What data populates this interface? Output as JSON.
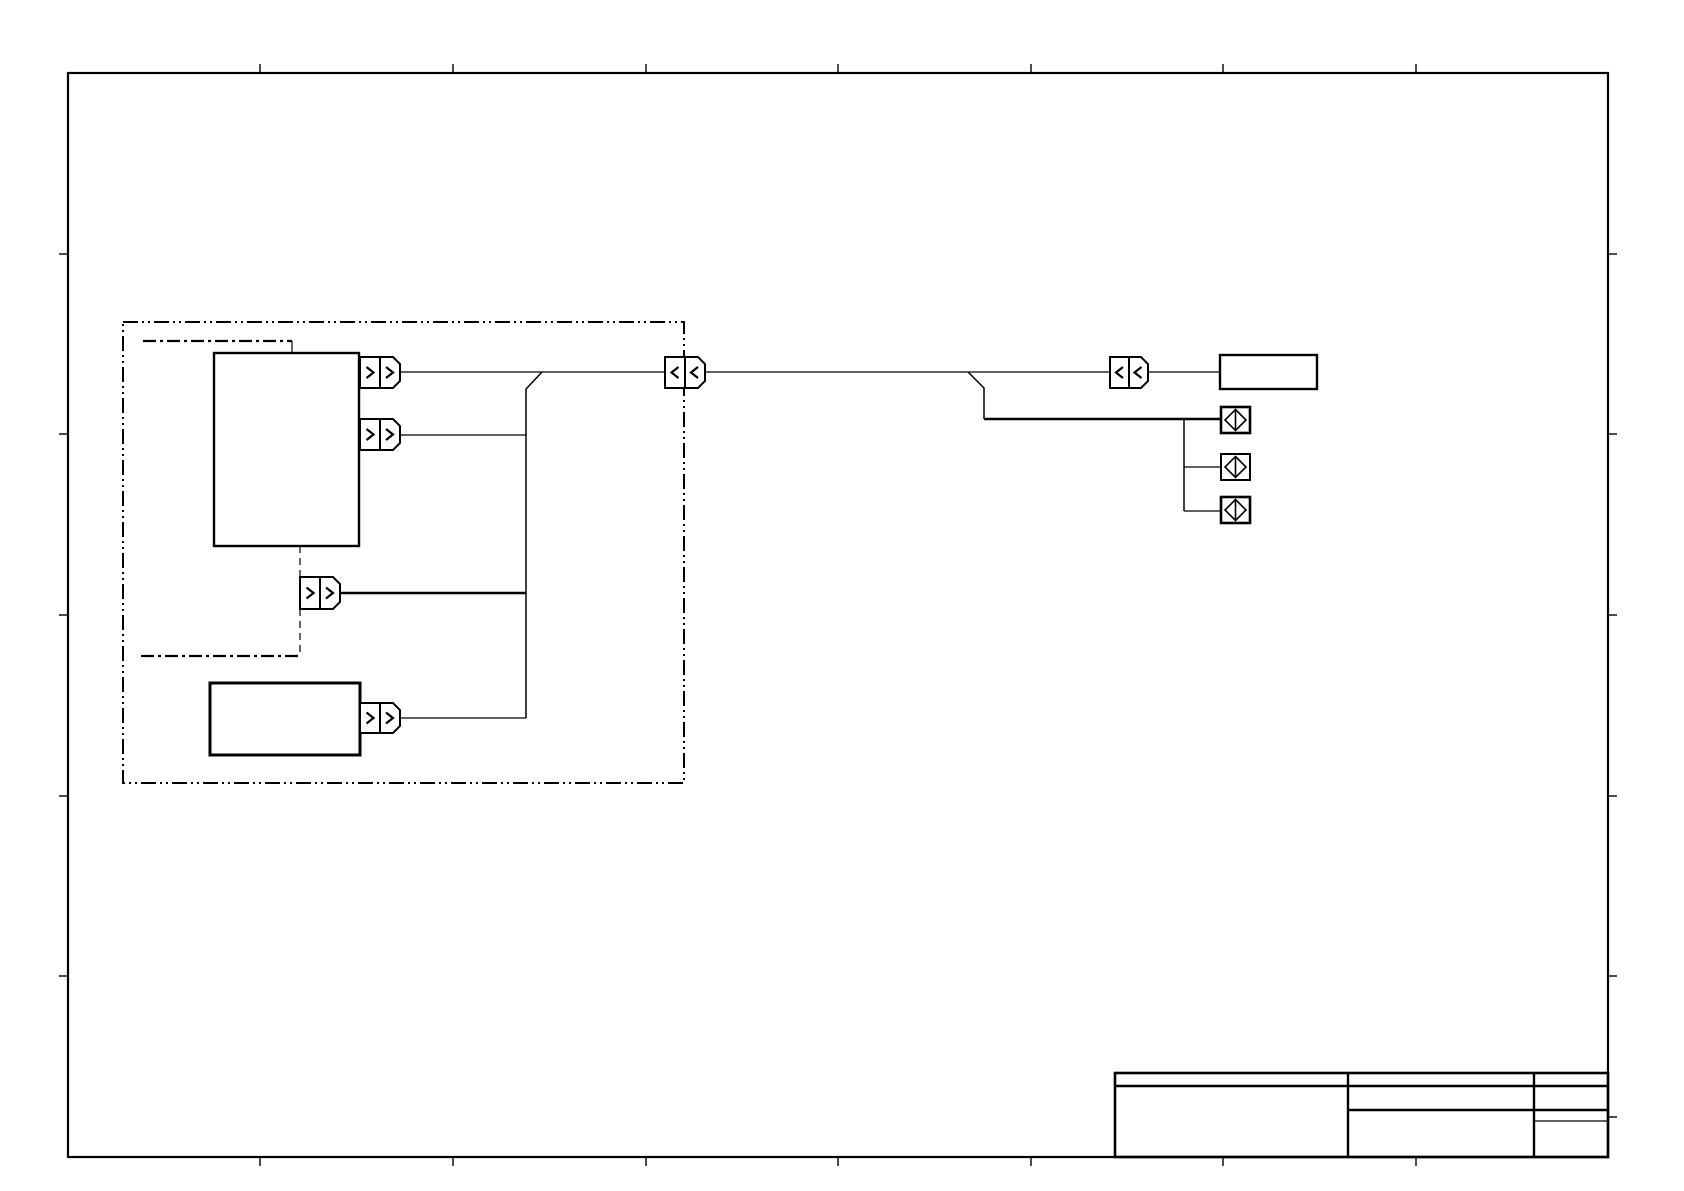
{
  "document": {
    "kind": "wiring-diagram-sheet",
    "background": "#ffffff",
    "ink": "#000000",
    "width": 1684,
    "height": 1191
  },
  "frame": {
    "x": 68,
    "y": 73,
    "w": 1540,
    "h": 1084,
    "stroke_width": 2.2,
    "tick_len": 9,
    "tick_stroke": 1.4,
    "ticks_top_x": [
      260,
      453,
      646,
      838,
      1031,
      1223,
      1416
    ],
    "ticks_bottom_x": [
      260,
      453,
      646,
      838,
      1031,
      1223,
      1416
    ],
    "ticks_left_y": [
      254,
      434,
      615,
      796,
      976
    ],
    "ticks_right_y": [
      254,
      434,
      615,
      796,
      976,
      1117
    ]
  },
  "shapes": [
    {
      "name": "component-group-boundary",
      "kind": "rect",
      "x": 123,
      "y": 322,
      "w": 561,
      "h": 461,
      "sw": 2,
      "dash": "15 4 2 4 2 4",
      "fill": "none",
      "inter": false
    },
    {
      "name": "sub-boundary-top-line",
      "kind": "line",
      "x1": 143,
      "y1": 341,
      "x2": 292,
      "y2": 341,
      "sw": 2.2,
      "dash": "13 4 3 4",
      "inter": false
    },
    {
      "name": "sub-boundary-top-drop",
      "kind": "line",
      "x1": 292,
      "y1": 341,
      "x2": 292,
      "y2": 353,
      "sw": 1.2,
      "inter": false
    },
    {
      "name": "sub-boundary-bottom-line",
      "kind": "line",
      "x1": 141,
      "y1": 656,
      "x2": 300,
      "y2": 656,
      "sw": 2.2,
      "dash": "13 4 3 4",
      "inter": false
    },
    {
      "name": "dashed-link-upper",
      "kind": "line",
      "x1": 300,
      "y1": 546,
      "x2": 300,
      "y2": 577,
      "sw": 1.2,
      "dash": "7 5",
      "inter": false
    },
    {
      "name": "dashed-link-lower",
      "kind": "line",
      "x1": 300,
      "y1": 609,
      "x2": 300,
      "y2": 656,
      "sw": 1.2,
      "dash": "7 5",
      "inter": false
    },
    {
      "name": "wire-main-left",
      "kind": "line",
      "x1": 400,
      "y1": 372,
      "x2": 665,
      "y2": 372,
      "sw": 1.3,
      "inter": false
    },
    {
      "name": "wire-main-mid",
      "kind": "line",
      "x1": 705,
      "y1": 372,
      "x2": 1110,
      "y2": 372,
      "sw": 1.3,
      "inter": false
    },
    {
      "name": "wire-main-right",
      "kind": "line",
      "x1": 1148,
      "y1": 372,
      "x2": 1220,
      "y2": 372,
      "sw": 1.3,
      "inter": false
    },
    {
      "name": "harness-vertical",
      "kind": "polyline",
      "pts": "542,372 526,389 526,718",
      "sw": 1.5,
      "inter": false
    },
    {
      "name": "wire-branch-2",
      "kind": "line",
      "x1": 400,
      "y1": 435,
      "x2": 526,
      "y2": 435,
      "sw": 1.3,
      "inter": false
    },
    {
      "name": "wire-branch-3-bold",
      "kind": "line",
      "x1": 340,
      "y1": 593,
      "x2": 526,
      "y2": 593,
      "sw": 2.6,
      "inter": false
    },
    {
      "name": "wire-branch-4",
      "kind": "line",
      "x1": 400,
      "y1": 718,
      "x2": 526,
      "y2": 718,
      "sw": 1.3,
      "inter": false
    },
    {
      "name": "wire-splice-drop",
      "kind": "polyline",
      "pts": "968,372 984,388 984,419",
      "sw": 1.5,
      "inter": false
    },
    {
      "name": "wire-splice-feed-bold",
      "kind": "line",
      "x1": 984,
      "y1": 419,
      "x2": 1221,
      "y2": 419,
      "sw": 2.6,
      "inter": false
    },
    {
      "name": "splice-bus-vertical",
      "kind": "line",
      "x1": 1184,
      "y1": 419,
      "x2": 1184,
      "y2": 511,
      "sw": 1.5,
      "inter": false
    },
    {
      "name": "splice-stub-2",
      "kind": "line",
      "x1": 1184,
      "y1": 467,
      "x2": 1221,
      "y2": 467,
      "sw": 1.3,
      "inter": false
    },
    {
      "name": "splice-stub-3",
      "kind": "line",
      "x1": 1184,
      "y1": 511,
      "x2": 1221,
      "y2": 511,
      "sw": 1.3,
      "inter": false
    },
    {
      "name": "component-box-main",
      "kind": "rect",
      "x": 214,
      "y": 353,
      "w": 145,
      "h": 193,
      "sw": 2.4,
      "fill": "#ffffff",
      "inter": true
    },
    {
      "name": "component-box-secondary",
      "kind": "rect",
      "x": 210,
      "y": 683,
      "w": 150,
      "h": 72,
      "sw": 3,
      "fill": "#ffffff",
      "inter": true
    },
    {
      "name": "component-box-right",
      "kind": "rect",
      "x": 1220,
      "y": 355,
      "w": 97,
      "h": 34,
      "sw": 2.4,
      "fill": "#ffffff",
      "inter": true
    },
    {
      "name": "connector-1-pin",
      "kind": "rect",
      "x": 360,
      "y": 357,
      "w": 20,
      "h": 31,
      "sw": 2,
      "fill": "#ffffff",
      "inter": true
    },
    {
      "name": "connector-1-housing",
      "kind": "polygon",
      "pts": "380,357 393,357 400,364 400,381 393,388 380,388",
      "sw": 2,
      "fill": "#ffffff",
      "inter": true
    },
    {
      "name": "connector-1-chevron-right-icon",
      "kind": "polyline",
      "pts": "366.5,367 373.5,372.5 366.5,378",
      "sw": 2.2,
      "inter": false
    },
    {
      "name": "connector-1-chevron-right-icon",
      "kind": "polyline",
      "pts": "386,367 393,372.5 386,378",
      "sw": 2.2,
      "inter": false
    },
    {
      "name": "connector-2-pin",
      "kind": "rect",
      "x": 360,
      "y": 419,
      "w": 20,
      "h": 31,
      "sw": 2,
      "fill": "#ffffff",
      "inter": true
    },
    {
      "name": "connector-2-housing",
      "kind": "polygon",
      "pts": "380,419 393,419 400,426 400,443 393,450 380,450",
      "sw": 2,
      "fill": "#ffffff",
      "inter": true
    },
    {
      "name": "connector-2-chevron-right-icon",
      "kind": "polyline",
      "pts": "366.5,429 373.5,434.5 366.5,440",
      "sw": 2.2,
      "inter": false
    },
    {
      "name": "connector-2-chevron-right-icon",
      "kind": "polyline",
      "pts": "386,429 393,434.5 386,440",
      "sw": 2.2,
      "inter": false
    },
    {
      "name": "connector-3-pin",
      "kind": "rect",
      "x": 300,
      "y": 577,
      "w": 20,
      "h": 32,
      "sw": 2,
      "fill": "#ffffff",
      "inter": true
    },
    {
      "name": "connector-3-housing",
      "kind": "polygon",
      "pts": "320,577 333,577 340,584 340,602 333,609 320,609",
      "sw": 2,
      "fill": "#ffffff",
      "inter": true
    },
    {
      "name": "connector-3-chevron-right-icon",
      "kind": "polyline",
      "pts": "306.5,587.5 313.5,593 306.5,598.5",
      "sw": 2.2,
      "inter": false
    },
    {
      "name": "connector-3-chevron-right-icon",
      "kind": "polyline",
      "pts": "326,587.5 333,593 326,598.5",
      "sw": 2.2,
      "inter": false
    },
    {
      "name": "connector-4-pin",
      "kind": "rect",
      "x": 360,
      "y": 703,
      "w": 20,
      "h": 30,
      "sw": 2,
      "fill": "#ffffff",
      "inter": true
    },
    {
      "name": "connector-4-housing",
      "kind": "polygon",
      "pts": "380,703 393,703 400,710 400,726 393,733 380,733",
      "sw": 2,
      "fill": "#ffffff",
      "inter": true
    },
    {
      "name": "connector-4-chevron-right-icon",
      "kind": "polyline",
      "pts": "366.5,712.5 373.5,718 366.5,723.5",
      "sw": 2.2,
      "inter": false
    },
    {
      "name": "connector-4-chevron-right-icon",
      "kind": "polyline",
      "pts": "386,712.5 393,718 386,723.5",
      "sw": 2.2,
      "inter": false
    },
    {
      "name": "inline-connector-left-pin",
      "kind": "rect",
      "x": 665,
      "y": 357,
      "w": 20,
      "h": 31,
      "sw": 2,
      "fill": "#ffffff",
      "inter": true
    },
    {
      "name": "inline-connector-left-housing",
      "kind": "polygon",
      "pts": "685,357 698,357 705,364 705,381 698,388 685,388",
      "sw": 2,
      "fill": "#ffffff",
      "inter": true
    },
    {
      "name": "inline-connector-left-chevron-left-icon",
      "kind": "polyline",
      "pts": "678.5,367 671.5,372.5 678.5,378",
      "sw": 2.2,
      "inter": false
    },
    {
      "name": "inline-connector-left-chevron-left-icon",
      "kind": "polyline",
      "pts": "698,367 691,372.5 698,378",
      "sw": 2.2,
      "inter": false
    },
    {
      "name": "inline-connector-right-pin",
      "kind": "rect",
      "x": 1110,
      "y": 357,
      "w": 19,
      "h": 31,
      "sw": 2,
      "fill": "#ffffff",
      "inter": true
    },
    {
      "name": "inline-connector-right-housing",
      "kind": "polygon",
      "pts": "1129,357 1141,357 1148,364 1148,381 1141,388 1129,388",
      "sw": 2,
      "fill": "#ffffff",
      "inter": true
    },
    {
      "name": "inline-connector-right-chevron-left-icon",
      "kind": "polyline",
      "pts": "1123,367 1116,372.5 1123,378",
      "sw": 2.2,
      "inter": false
    },
    {
      "name": "inline-connector-right-chevron-left-icon",
      "kind": "polyline",
      "pts": "1141.5,367 1134.5,372.5 1141.5,378",
      "sw": 2.2,
      "inter": false
    },
    {
      "name": "splice-box-1",
      "kind": "rect",
      "x": 1221,
      "y": 407,
      "w": 29,
      "h": 26,
      "sw": 2.6,
      "fill": "#ffffff",
      "inter": true
    },
    {
      "name": "splice-diamond-icon",
      "kind": "polygon",
      "pts": "1235.5,409.5 1246,420 1235.5,430.5 1225,420",
      "sw": 1.6,
      "fill": "none",
      "inter": false
    },
    {
      "name": "splice-diamond-bar-icon",
      "kind": "line",
      "x1": 1235.5,
      "y1": 409.5,
      "x2": 1235.5,
      "y2": 430.5,
      "sw": 1.6,
      "inter": false
    },
    {
      "name": "splice-box-2",
      "kind": "rect",
      "x": 1221,
      "y": 454,
      "w": 29,
      "h": 26,
      "sw": 2,
      "fill": "#ffffff",
      "inter": true
    },
    {
      "name": "splice-diamond-icon",
      "kind": "polygon",
      "pts": "1235.5,456.5 1246,467 1235.5,477.5 1225,467",
      "sw": 1.6,
      "fill": "none",
      "inter": false
    },
    {
      "name": "splice-diamond-bar-icon",
      "kind": "line",
      "x1": 1235.5,
      "y1": 456.5,
      "x2": 1235.5,
      "y2": 477.5,
      "sw": 1.6,
      "inter": false
    },
    {
      "name": "splice-box-3",
      "kind": "rect",
      "x": 1221,
      "y": 497,
      "w": 29,
      "h": 26,
      "sw": 2.6,
      "fill": "#ffffff",
      "inter": true
    },
    {
      "name": "splice-diamond-icon",
      "kind": "polygon",
      "pts": "1235.5,499.5 1246,510 1235.5,520.5 1225,510",
      "sw": 1.6,
      "fill": "none",
      "inter": false
    },
    {
      "name": "splice-diamond-bar-icon",
      "kind": "line",
      "x1": 1235.5,
      "y1": 499.5,
      "x2": 1235.5,
      "y2": 520.5,
      "sw": 1.6,
      "inter": false
    },
    {
      "name": "title-block-outline",
      "kind": "rect",
      "x": 1115,
      "y": 1073,
      "w": 493,
      "h": 84,
      "sw": 2.6,
      "fill": "none",
      "inter": false
    },
    {
      "name": "title-block-header-rule",
      "kind": "line",
      "x1": 1115,
      "y1": 1086,
      "x2": 1608,
      "y2": 1086,
      "sw": 2.4,
      "inter": false
    },
    {
      "name": "title-block-divider-1",
      "kind": "line",
      "x1": 1348,
      "y1": 1073,
      "x2": 1348,
      "y2": 1157,
      "sw": 2.4,
      "inter": false
    },
    {
      "name": "title-block-divider-2",
      "kind": "line",
      "x1": 1534,
      "y1": 1073,
      "x2": 1534,
      "y2": 1157,
      "sw": 2.4,
      "inter": false
    },
    {
      "name": "title-block-row-rule",
      "kind": "line",
      "x1": 1348,
      "y1": 1110,
      "x2": 1608,
      "y2": 1110,
      "sw": 2.4,
      "inter": false
    },
    {
      "name": "title-block-subrow-rule",
      "kind": "line",
      "x1": 1534,
      "y1": 1121,
      "x2": 1608,
      "y2": 1121,
      "sw": 1.2,
      "inter": false
    }
  ]
}
